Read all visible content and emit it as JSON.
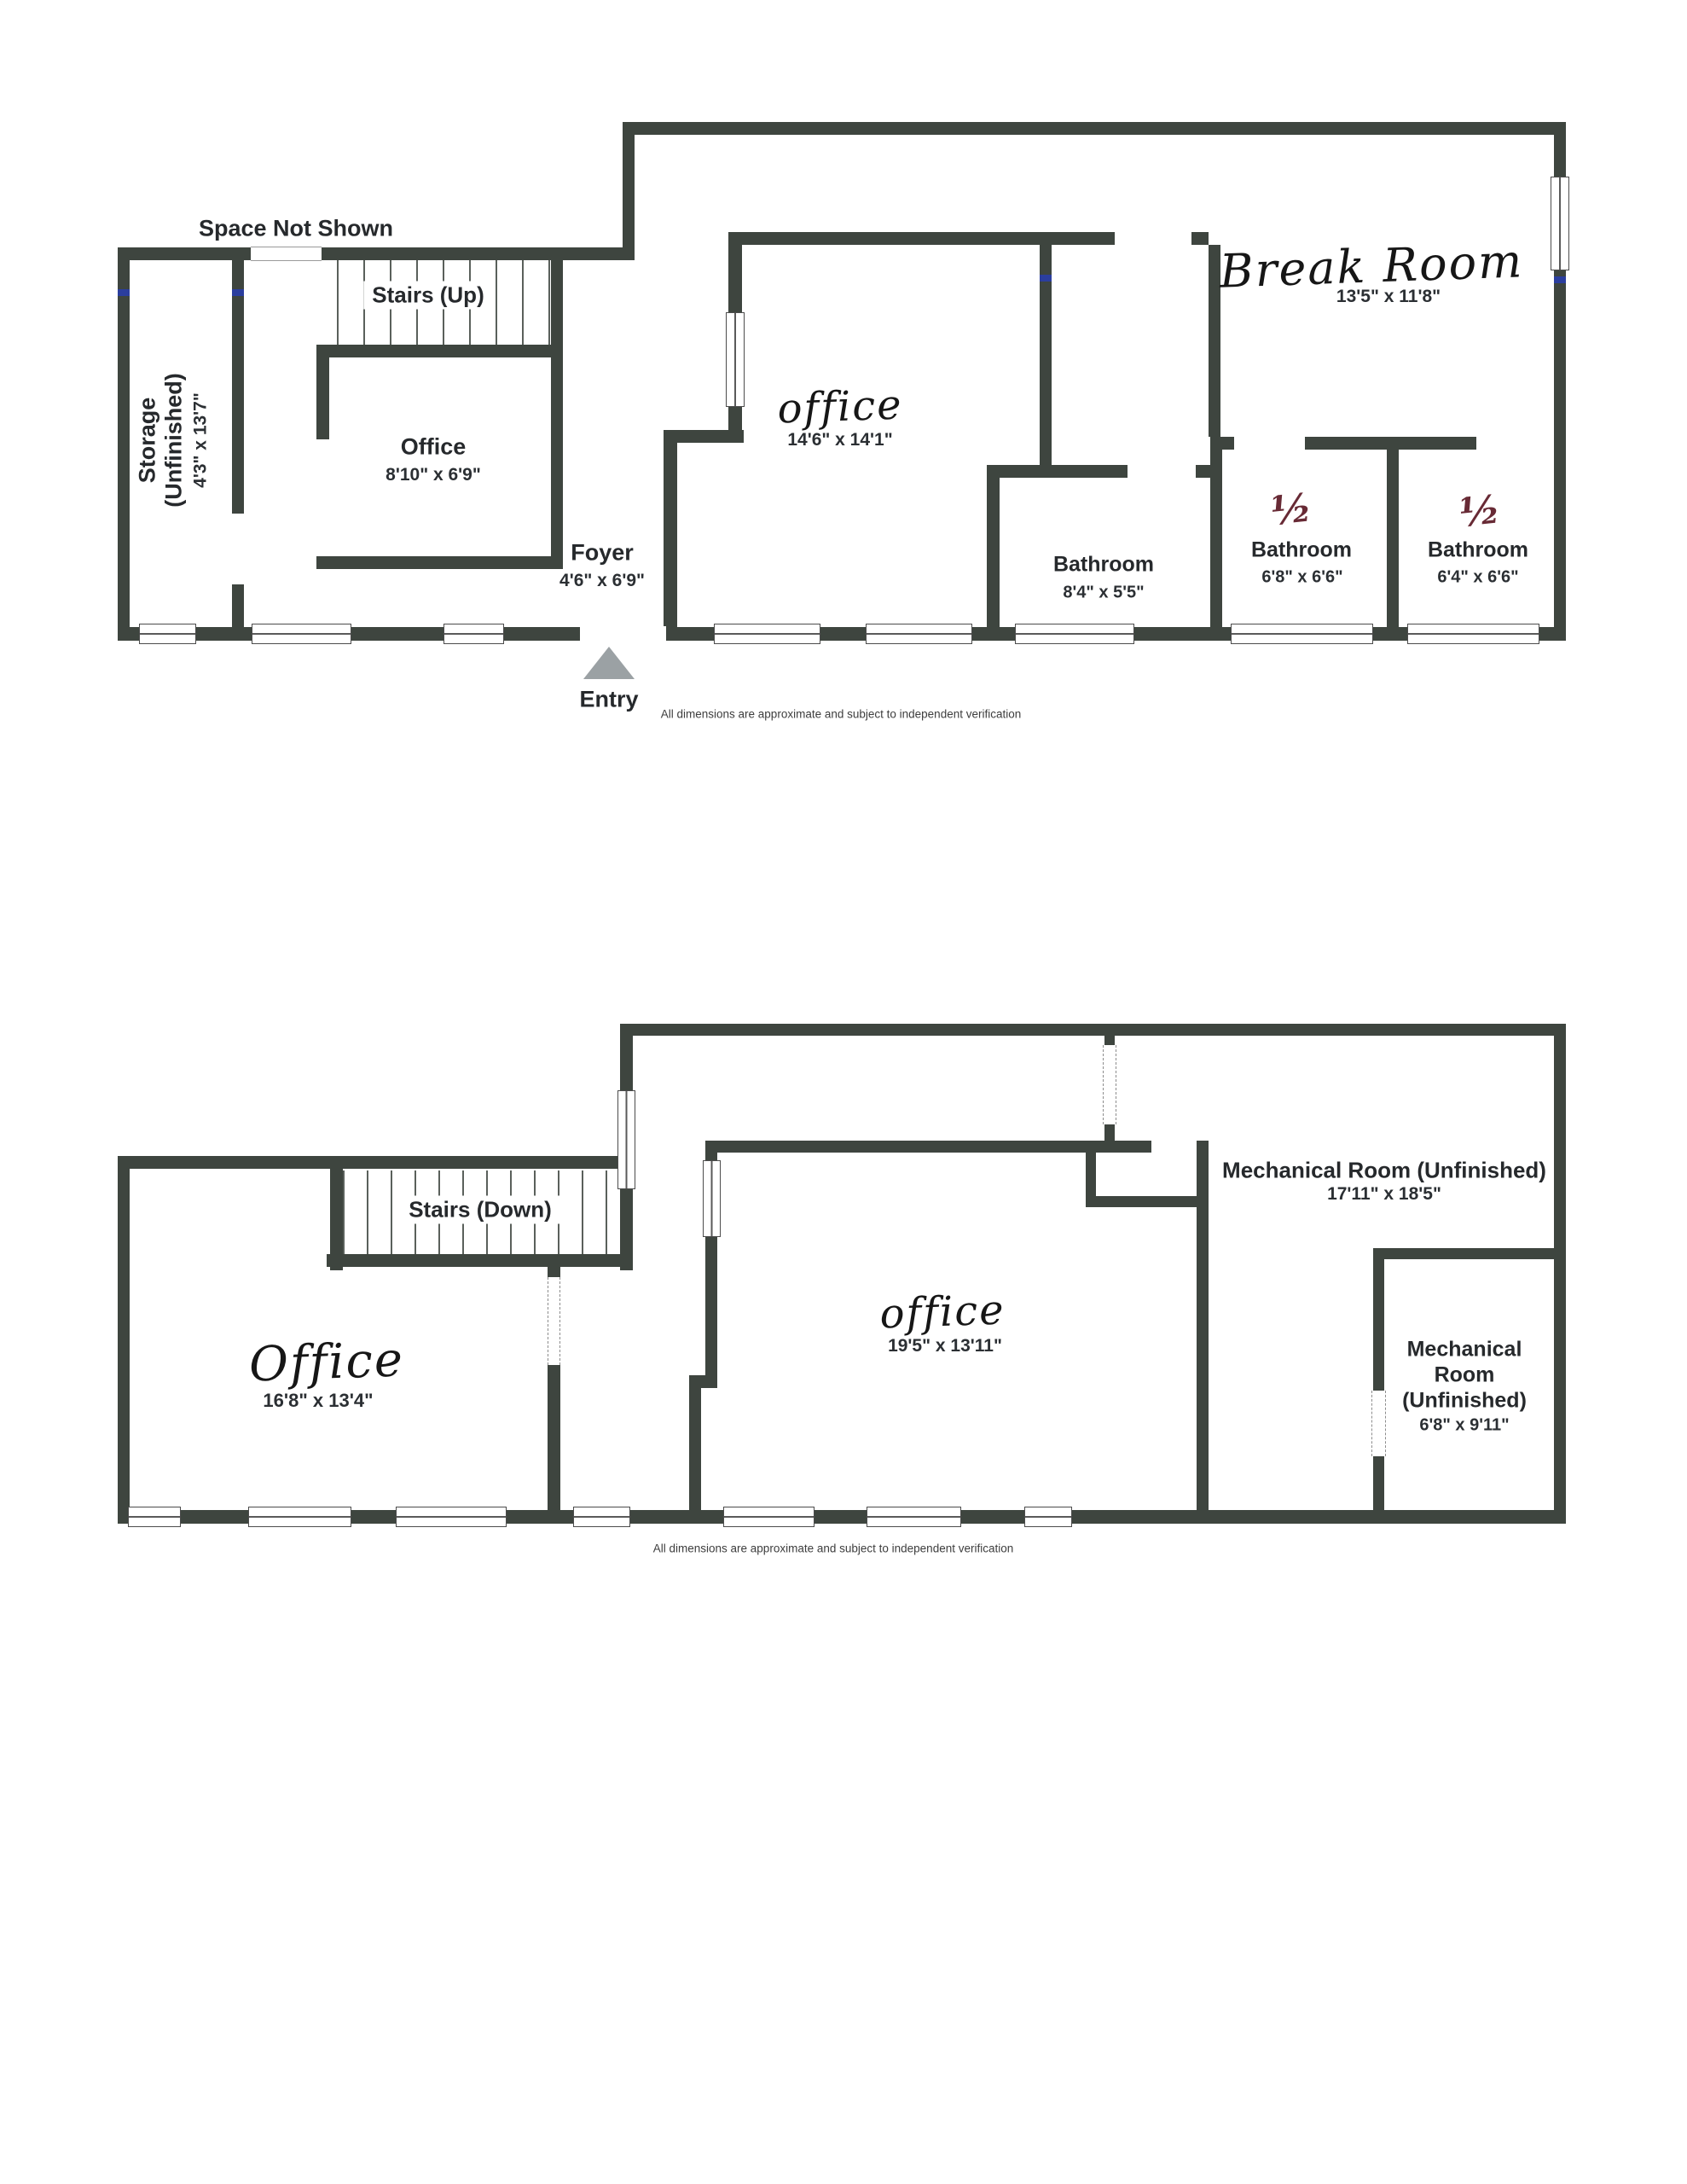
{
  "floors": {
    "upper": {
      "space_not_shown": "Space Not Shown",
      "stairs": "Stairs (Up)",
      "storage": {
        "name_line1": "Storage",
        "name_line2": "(Unfinished)",
        "dims": "4'3\" x 13'7\""
      },
      "office_small": {
        "name": "Office",
        "dims": "8'10\" x 6'9\""
      },
      "office_main": {
        "name": "office",
        "dims": "14'6\" x 14'1\""
      },
      "foyer": {
        "name": "Foyer",
        "dims": "4'6\" x 6'9\""
      },
      "entry": "Entry",
      "bathroom": {
        "name": "Bathroom",
        "dims": "8'4\" x 5'5\""
      },
      "half_bath_1": {
        "fraction": "½",
        "name": "Bathroom",
        "dims": "6'8\" x 6'6\""
      },
      "half_bath_2": {
        "fraction": "½",
        "name": "Bathroom",
        "dims": "6'4\" x 6'6\""
      },
      "break_room": {
        "name": "Break Room",
        "dims": "13'5\" x 11'8\""
      },
      "disclaimer": "All dimensions are approximate and subject to independent verification"
    },
    "lower": {
      "stairs": "Stairs (Down)",
      "office_left": {
        "name": "Office",
        "dims": "16'8\" x 13'4\""
      },
      "office_center": {
        "name": "office",
        "dims": "19'5\" x 13'11\""
      },
      "mech_room_large": {
        "name": "Mechanical Room (Unfinished)",
        "dims": "17'11\" x 18'5\""
      },
      "mech_room_small": {
        "line1": "Mechanical",
        "line2": "Room",
        "line3": "(Unfinished)",
        "dims": "6'8\" x 9'11\""
      },
      "disclaimer": "All dimensions are approximate and subject to independent verification"
    }
  },
  "colors": {
    "wall": "#3e453f",
    "handwriting": "#161616",
    "fraction_ink": "#682a35",
    "entry_marker": "#9ba1a4",
    "blue_mark": "#2b3e9e"
  }
}
